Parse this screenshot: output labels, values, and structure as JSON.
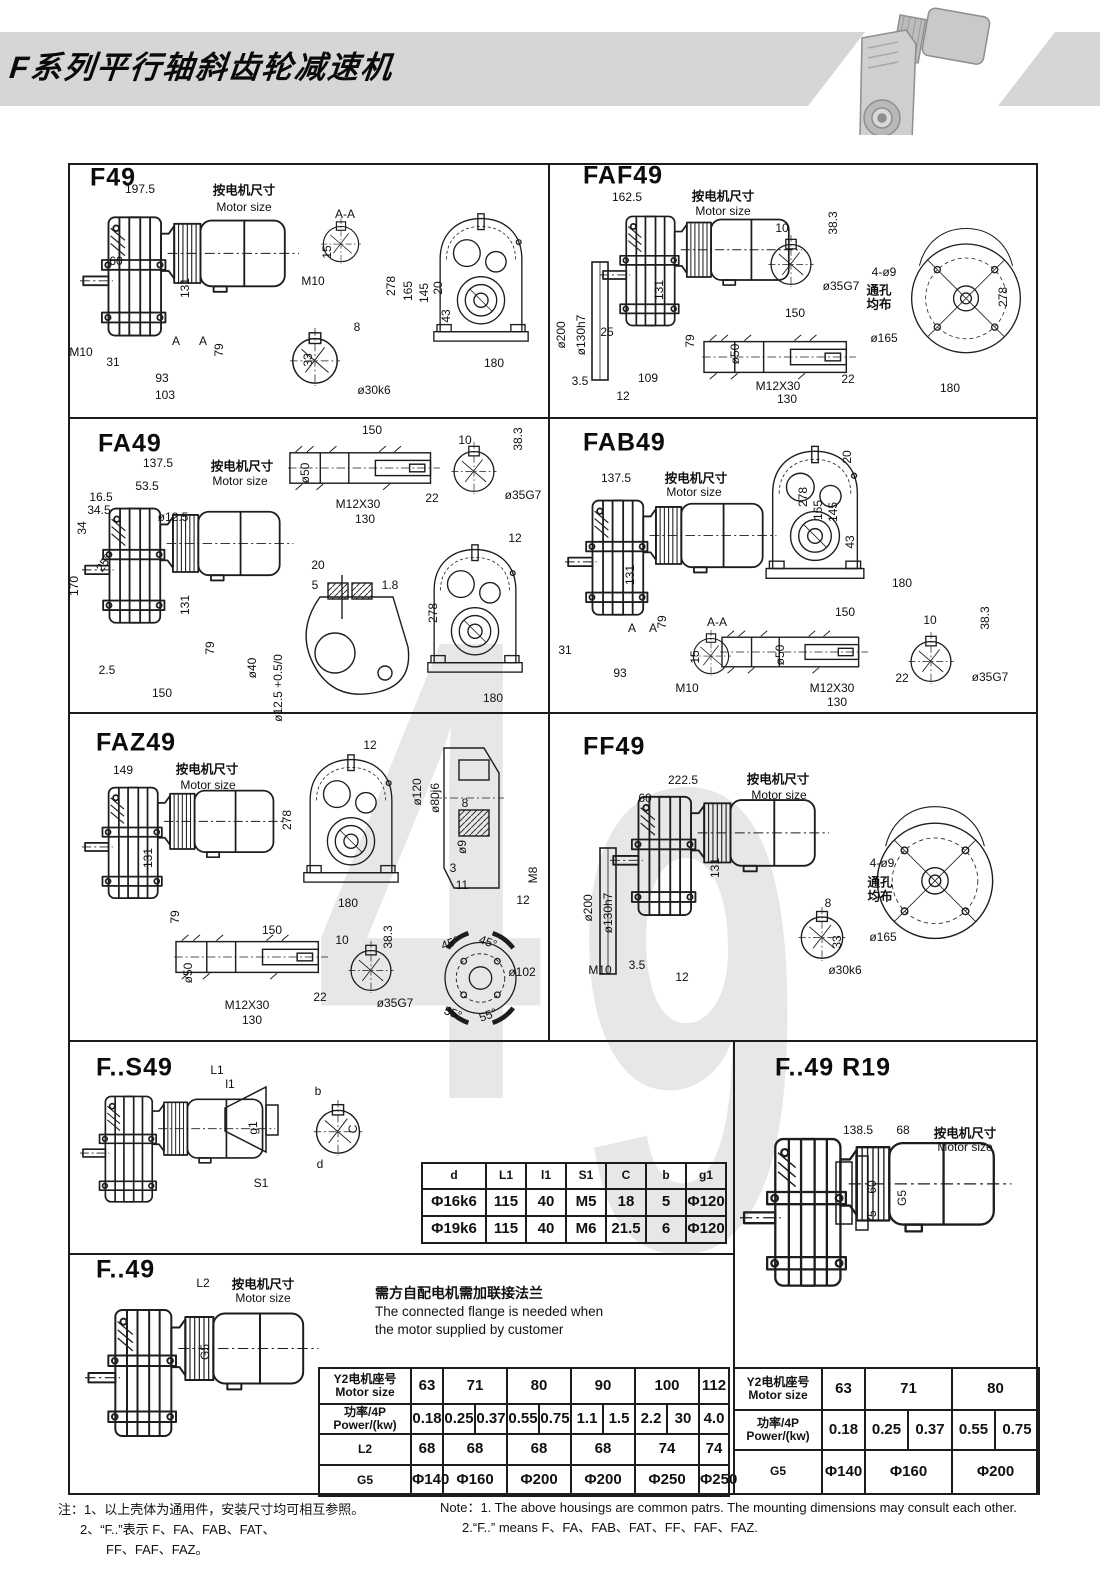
{
  "header": {
    "title": "F系列平行轴斜齿轮减速机"
  },
  "watermark": {
    "d1": "4",
    "d2": "9"
  },
  "flange_note": {
    "cn": "需方自配电机需加联接法兰",
    "en1": "The connected flange is needed when",
    "en2": "the motor supplied by customer"
  },
  "notes": {
    "cn1": "注：1、以上壳体为通用件，安装尺寸均可相互参照。",
    "cn2": "2、“F..”表示 F、FA、FAB、FAT、",
    "cn3": "FF、FAF、FAZ。",
    "en1": "Note：1.  The above housings are common patrs. The mounting dimensions may consult each other.",
    "en2": "2.“F..” means F、FA、FAB、FAT、FF、FAF、FAZ."
  },
  "panels": [
    {
      "title": "F49",
      "tx": 90,
      "ty": 178,
      "labels": [
        [
          "197.5",
          140,
          189
        ],
        [
          "按电机尺寸",
          244,
          189,
          0,
          1
        ],
        [
          "Motor size",
          244,
          207
        ],
        [
          "A-A",
          345,
          214
        ],
        [
          "15",
          327,
          252,
          -90
        ],
        [
          "M10",
          313,
          281
        ],
        [
          "60",
          116,
          261
        ],
        [
          "131",
          185,
          288,
          -90
        ],
        [
          "M10",
          81,
          352
        ],
        [
          "31",
          113,
          362
        ],
        [
          "A",
          176,
          341
        ],
        [
          "A",
          203,
          341
        ],
        [
          "79",
          219,
          350,
          -90
        ],
        [
          "93",
          162,
          378
        ],
        [
          "103",
          165,
          395
        ],
        [
          "8",
          357,
          327
        ],
        [
          "33",
          308,
          360,
          -90
        ],
        [
          "ø30k6",
          374,
          390
        ],
        [
          "278",
          391,
          286,
          -90
        ],
        [
          "165",
          408,
          291,
          -90
        ],
        [
          "145",
          424,
          293,
          -90
        ],
        [
          "20",
          438,
          288,
          -90
        ],
        [
          "43",
          446,
          316,
          -90
        ],
        [
          "180",
          494,
          363
        ]
      ]
    },
    {
      "title": "FAF49",
      "tx": 583,
      "ty": 176,
      "labels": [
        [
          "162.5",
          627,
          197
        ],
        [
          "按电机尺寸",
          723,
          195,
          0,
          1
        ],
        [
          "Motor size",
          723,
          211
        ],
        [
          "10",
          782,
          228
        ],
        [
          "38.3",
          833,
          223,
          -90
        ],
        [
          "ø35G7",
          841,
          286
        ],
        [
          "131",
          659,
          290,
          -90
        ],
        [
          "ø200",
          561,
          335,
          -90
        ],
        [
          "ø130h7",
          581,
          335,
          -90
        ],
        [
          "25",
          607,
          332
        ],
        [
          "79",
          690,
          341,
          -90
        ],
        [
          "3.5",
          580,
          381
        ],
        [
          "12",
          623,
          396
        ],
        [
          "109",
          648,
          378
        ],
        [
          "150",
          795,
          313
        ],
        [
          "ø50",
          735,
          354,
          -90
        ],
        [
          "M12X30",
          778,
          386
        ],
        [
          "22",
          848,
          379
        ],
        [
          "130",
          787,
          399
        ],
        [
          "4-ø9",
          884,
          272
        ],
        [
          "通孔",
          879,
          289,
          0,
          1
        ],
        [
          "均布",
          879,
          303,
          0,
          1
        ],
        [
          "ø165",
          884,
          338
        ],
        [
          "278",
          1003,
          297,
          -90
        ],
        [
          "180",
          950,
          388
        ]
      ]
    },
    {
      "title": "FA49",
      "tx": 98,
      "ty": 444,
      "labels": [
        [
          "137.5",
          158,
          463
        ],
        [
          "按电机尺寸",
          242,
          465,
          0,
          1
        ],
        [
          "Motor size",
          240,
          481
        ],
        [
          "53.5",
          147,
          486
        ],
        [
          "16.5",
          101,
          497
        ],
        [
          "34.5",
          99,
          510
        ],
        [
          "34",
          82,
          528,
          -90
        ],
        [
          "ø12.5",
          173,
          517
        ],
        [
          "25°",
          104,
          563,
          -55
        ],
        [
          "170",
          74,
          586,
          -90
        ],
        [
          "131",
          185,
          605,
          -90
        ],
        [
          "79",
          210,
          648,
          -90
        ],
        [
          "2.5",
          107,
          670
        ],
        [
          "150",
          162,
          693
        ],
        [
          "150",
          372,
          430
        ],
        [
          "ø50",
          305,
          473,
          -90
        ],
        [
          "M12X30",
          358,
          504
        ],
        [
          "22",
          432,
          498
        ],
        [
          "130",
          365,
          519
        ],
        [
          "10",
          465,
          440
        ],
        [
          "38.3",
          518,
          439,
          -90
        ],
        [
          "ø35G7",
          523,
          495
        ],
        [
          "20",
          318,
          565
        ],
        [
          "5",
          315,
          585
        ],
        [
          "1.8",
          390,
          585
        ],
        [
          "ø40",
          252,
          668,
          -90
        ],
        [
          "ø12.5 +0.5/0",
          278,
          688,
          -90
        ],
        [
          "12",
          515,
          538
        ],
        [
          "278",
          433,
          613,
          -90
        ],
        [
          "180",
          493,
          698
        ]
      ]
    },
    {
      "title": "FAB49",
      "tx": 583,
      "ty": 443,
      "labels": [
        [
          "137.5",
          616,
          478
        ],
        [
          "按电机尺寸",
          696,
          477,
          0,
          1
        ],
        [
          "Motor size",
          694,
          492
        ],
        [
          "131",
          630,
          575,
          -90
        ],
        [
          "79",
          662,
          622,
          -90
        ],
        [
          "A",
          632,
          628
        ],
        [
          "A",
          653,
          628
        ],
        [
          "31",
          565,
          650
        ],
        [
          "93",
          620,
          673
        ],
        [
          "A-A",
          717,
          622
        ],
        [
          "15",
          695,
          657,
          -90
        ],
        [
          "M10",
          687,
          688
        ],
        [
          "278",
          803,
          497,
          -90
        ],
        [
          "165",
          818,
          510,
          -90
        ],
        [
          "145",
          833,
          512,
          -90
        ],
        [
          "20",
          847,
          457,
          -90
        ],
        [
          "43",
          850,
          542,
          -90
        ],
        [
          "180",
          902,
          583
        ],
        [
          "150",
          845,
          612
        ],
        [
          "ø50",
          780,
          655,
          -90
        ],
        [
          "M12X30",
          832,
          688
        ],
        [
          "22",
          902,
          678
        ],
        [
          "130",
          837,
          702
        ],
        [
          "10",
          930,
          620
        ],
        [
          "38.3",
          985,
          618,
          -90
        ],
        [
          "ø35G7",
          990,
          677
        ]
      ]
    },
    {
      "title": "FAZ49",
      "tx": 96,
      "ty": 743,
      "labels": [
        [
          "149",
          123,
          770
        ],
        [
          "按电机尺寸",
          207,
          768,
          0,
          1
        ],
        [
          "Motor size",
          208,
          785
        ],
        [
          "131",
          148,
          858,
          -90
        ],
        [
          "79",
          175,
          917,
          -90
        ],
        [
          "12",
          370,
          745
        ],
        [
          "278",
          287,
          820,
          -90
        ],
        [
          "180",
          348,
          903
        ],
        [
          "ø120",
          417,
          792,
          -90
        ],
        [
          "ø80j6",
          435,
          798,
          -90
        ],
        [
          "8",
          465,
          803
        ],
        [
          "ø9",
          462,
          847,
          -90
        ],
        [
          "3",
          453,
          868
        ],
        [
          "11",
          462,
          885
        ],
        [
          "M8",
          533,
          875,
          -90
        ],
        [
          "12",
          523,
          900
        ],
        [
          "150",
          272,
          930
        ],
        [
          "ø50",
          188,
          973,
          -90
        ],
        [
          "M12X30",
          247,
          1005
        ],
        [
          "22",
          320,
          997
        ],
        [
          "130",
          252,
          1020
        ],
        [
          "10",
          342,
          940
        ],
        [
          "38.3",
          388,
          937,
          -90
        ],
        [
          "ø35G7",
          395,
          1003
        ],
        [
          "45°",
          450,
          943,
          -20
        ],
        [
          "45°",
          488,
          942,
          20
        ],
        [
          "ø102",
          522,
          972
        ],
        [
          "55°",
          453,
          1013,
          20
        ],
        [
          "55°",
          488,
          1015,
          -20
        ]
      ]
    },
    {
      "title": "FF49",
      "tx": 583,
      "ty": 747,
      "labels": [
        [
          "222.5",
          683,
          780
        ],
        [
          "按电机尺寸",
          778,
          778,
          0,
          1
        ],
        [
          "Motor size",
          779,
          795
        ],
        [
          "60",
          645,
          798
        ],
        [
          "131",
          715,
          868,
          -90
        ],
        [
          "ø200",
          588,
          908,
          -90
        ],
        [
          "ø130h7",
          608,
          913,
          -90
        ],
        [
          "M10",
          600,
          970
        ],
        [
          "3.5",
          637,
          965
        ],
        [
          "12",
          682,
          977
        ],
        [
          "8",
          828,
          903
        ],
        [
          "33",
          837,
          942,
          -90
        ],
        [
          "ø30k6",
          845,
          970
        ],
        [
          "4-ø9",
          882,
          863
        ],
        [
          "通孔",
          880,
          881,
          0,
          1
        ],
        [
          "均布",
          880,
          895,
          0,
          1
        ],
        [
          "ø165",
          883,
          937
        ]
      ]
    },
    {
      "title": "F..S49",
      "tx": 96,
      "ty": 1068,
      "labels": [
        [
          "L1",
          217,
          1070
        ],
        [
          "l1",
          230,
          1084
        ],
        [
          "g1",
          253,
          1128,
          -90
        ],
        [
          "S1",
          261,
          1183
        ],
        [
          "b",
          318,
          1091
        ],
        [
          "C",
          353,
          1129,
          -90
        ],
        [
          "d",
          320,
          1164
        ]
      ]
    },
    {
      "title": "F..49  R19",
      "tx": 775,
      "ty": 1068,
      "labels": [
        [
          "138.5",
          858,
          1130
        ],
        [
          "68",
          903,
          1130
        ],
        [
          "按电机尺寸",
          965,
          1132,
          0,
          1
        ],
        [
          "Motor size",
          965,
          1147
        ],
        [
          "60",
          872,
          1187,
          -90
        ],
        [
          "75",
          872,
          1217,
          -90
        ],
        [
          "G5",
          902,
          1198,
          -90
        ]
      ]
    },
    {
      "title": "F..49",
      "tx": 96,
      "ty": 1270,
      "labels": [
        [
          "L2",
          203,
          1283
        ],
        [
          "按电机尺寸",
          263,
          1283,
          0,
          1
        ],
        [
          "Motor size",
          263,
          1298
        ],
        [
          "G5",
          205,
          1352,
          -90
        ]
      ]
    }
  ],
  "tables": [
    {
      "name": "s49-dim-table",
      "x": 421,
      "y": 1162,
      "w": 304,
      "rowh": [
        26,
        27,
        27
      ],
      "colw": [
        64,
        40,
        40,
        40,
        40,
        40,
        40
      ],
      "rows": [
        [
          {
            "t": "d",
            "h": 1
          },
          {
            "t": "L1",
            "h": 1
          },
          {
            "t": "l1",
            "h": 1
          },
          {
            "t": "S1",
            "h": 1
          },
          {
            "t": "C",
            "h": 1
          },
          {
            "t": "b",
            "h": 1
          },
          {
            "t": "g1",
            "h": 1
          }
        ],
        [
          {
            "t": "Φ16k6"
          },
          {
            "t": "115"
          },
          {
            "t": "40"
          },
          {
            "t": "M5"
          },
          {
            "t": "18"
          },
          {
            "t": "5"
          },
          {
            "t": "Φ120"
          }
        ],
        [
          {
            "t": "Φ19k6"
          },
          {
            "t": "115"
          },
          {
            "t": "40"
          },
          {
            "t": "M6"
          },
          {
            "t": "21.5"
          },
          {
            "t": "6"
          },
          {
            "t": "Φ120"
          }
        ]
      ]
    },
    {
      "name": "motor-table-main",
      "x": 318,
      "y": 1367,
      "w": 410,
      "rowh": [
        36,
        30,
        31,
        31
      ],
      "colw": [
        92,
        32,
        32,
        32,
        32,
        32,
        32,
        32,
        32,
        32,
        30
      ],
      "rows": [
        [
          {
            "t": "Y2电机座号\nMotor size",
            "h": 1
          },
          {
            "t": "63"
          },
          {
            "t": "71",
            "cs": 2
          },
          {
            "t": "80",
            "cs": 2
          },
          {
            "t": "90",
            "cs": 2
          },
          {
            "t": "100",
            "cs": 2
          },
          {
            "t": "112"
          }
        ],
        [
          {
            "t": "功率/4P\nPower/(kw)",
            "h": 1
          },
          {
            "t": "0.18"
          },
          {
            "t": "0.25"
          },
          {
            "t": "0.37"
          },
          {
            "t": "0.55"
          },
          {
            "t": "0.75"
          },
          {
            "t": "1.1"
          },
          {
            "t": "1.5"
          },
          {
            "t": "2.2"
          },
          {
            "t": "30"
          },
          {
            "t": "4.0"
          }
        ],
        [
          {
            "t": "L2",
            "h": 1
          },
          {
            "t": "68"
          },
          {
            "t": "68",
            "cs": 2
          },
          {
            "t": "68",
            "cs": 2
          },
          {
            "t": "68",
            "cs": 2
          },
          {
            "t": "74",
            "cs": 2
          },
          {
            "t": "74"
          }
        ],
        [
          {
            "t": "G5",
            "h": 1
          },
          {
            "t": "Φ140"
          },
          {
            "t": "Φ160",
            "cs": 2
          },
          {
            "t": "Φ200",
            "cs": 2
          },
          {
            "t": "Φ200",
            "cs": 2
          },
          {
            "t": "Φ250",
            "cs": 2
          },
          {
            "t": "Φ250"
          }
        ]
      ]
    },
    {
      "name": "motor-table-r19",
      "x": 733,
      "y": 1367,
      "w": 305,
      "rowh": [
        42,
        40,
        44
      ],
      "colw": [
        88,
        43,
        43,
        44,
        43,
        44
      ],
      "rows": [
        [
          {
            "t": "Y2电机座号\nMotor size",
            "h": 1
          },
          {
            "t": "63"
          },
          {
            "t": "71",
            "cs": 2
          },
          {
            "t": "80",
            "cs": 2
          }
        ],
        [
          {
            "t": "功率/4P\nPower/(kw)",
            "h": 1
          },
          {
            "t": "0.18"
          },
          {
            "t": "0.25"
          },
          {
            "t": "0.37"
          },
          {
            "t": "0.55"
          },
          {
            "t": "0.75"
          }
        ],
        [
          {
            "t": "G5",
            "h": 1
          },
          {
            "t": "Φ140"
          },
          {
            "t": "Φ160",
            "cs": 2
          },
          {
            "t": "Φ200",
            "cs": 2
          }
        ]
      ]
    }
  ]
}
